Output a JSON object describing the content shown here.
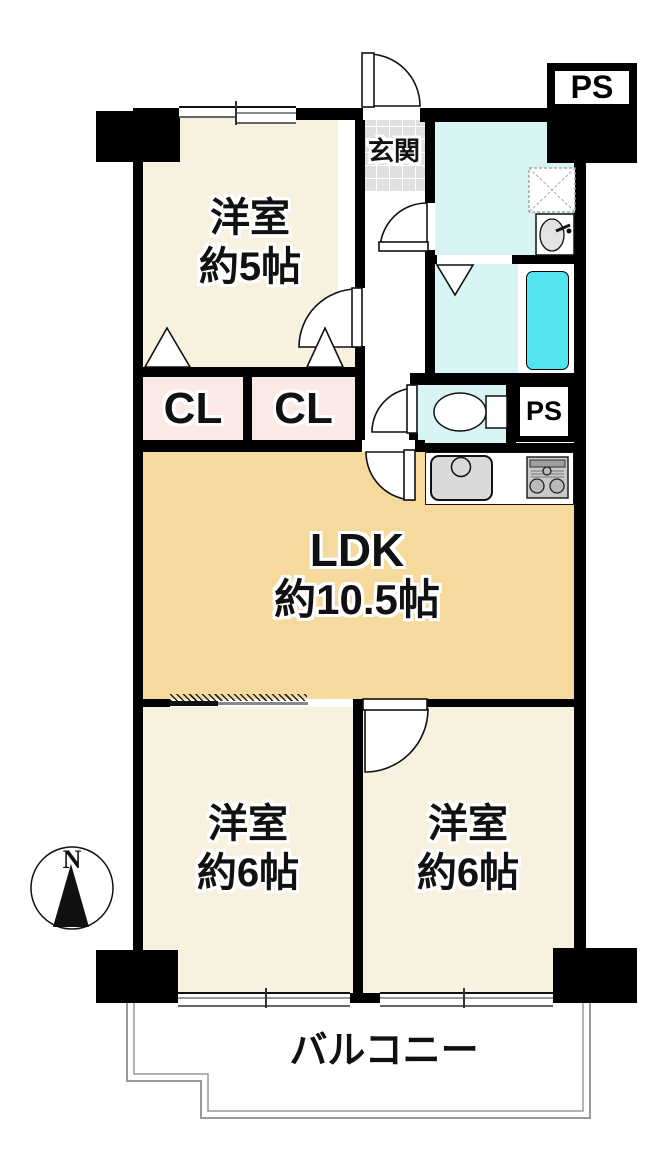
{
  "rooms": {
    "bedroom_5": {
      "name": "洋室",
      "size": "約5帖"
    },
    "ldk": {
      "name": "LDK",
      "size": "約10.5帖"
    },
    "bedroom_6_left": {
      "name": "洋室",
      "size": "約6帖"
    },
    "bedroom_6_right": {
      "name": "洋室",
      "size": "約6帖"
    }
  },
  "areas": {
    "entrance": "玄関",
    "balcony": "バルコニー",
    "closet_left": "CL",
    "closet_right": "CL",
    "pipe_space_top": "PS",
    "pipe_space_mid": "PS"
  },
  "compass": {
    "north": "N"
  },
  "colors": {
    "wall": "#000000",
    "room": "#f8f1df",
    "ldk": "#f6d99d",
    "closet": "#fbe9e6",
    "wet": "#d9f4f4",
    "tub": "#53e3ee",
    "genkan": "#e0e0e0",
    "outline": "#999999"
  }
}
